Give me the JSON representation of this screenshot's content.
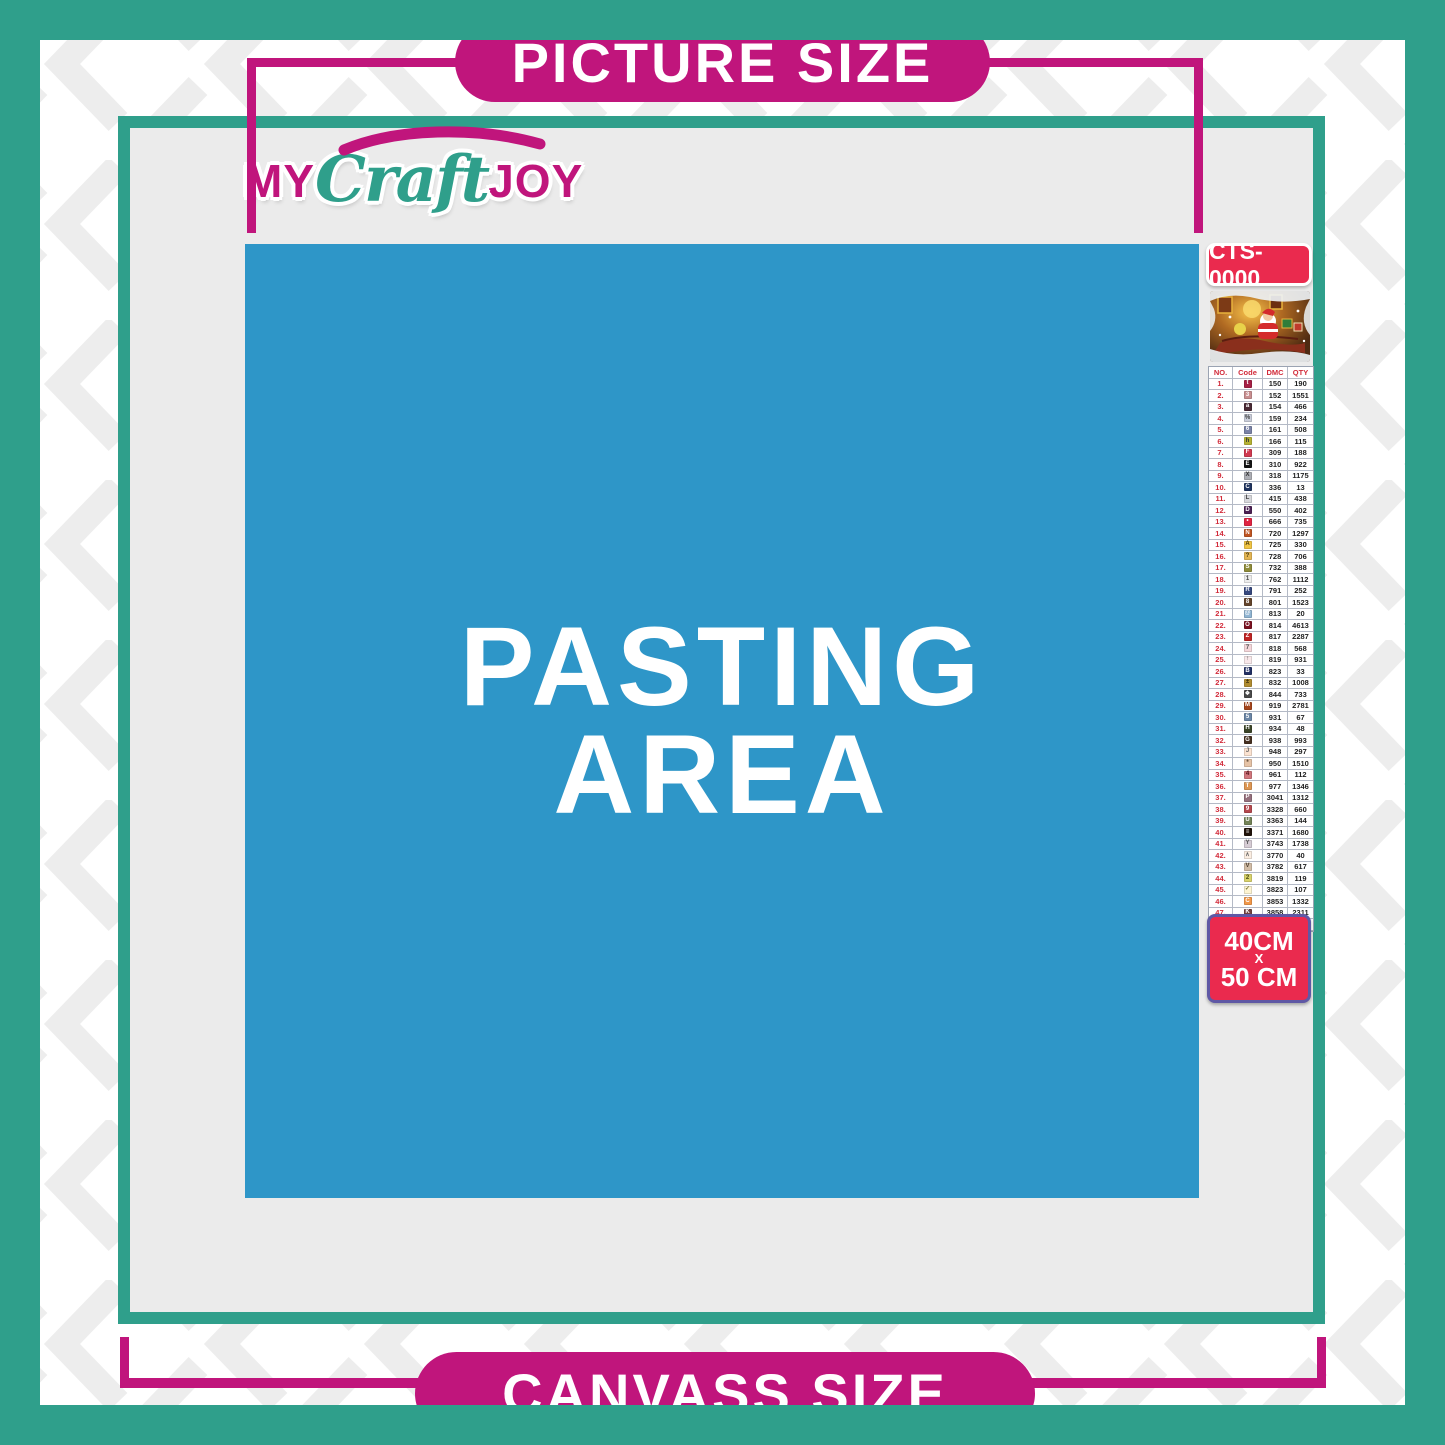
{
  "header": {
    "picture_size_label": "PICTURE SIZE"
  },
  "footer": {
    "canvass_size_label": "CANVASS SIZE"
  },
  "logo": {
    "part1": "MY",
    "part2": "Craft",
    "part3": "JOY"
  },
  "pasting_area": {
    "line1": "PASTING",
    "line2": "AREA"
  },
  "sidebar": {
    "sku": "CTS-0000",
    "size_badge": {
      "line1": "40CM",
      "line2": "X",
      "line3": "50 CM"
    },
    "table": {
      "headers": [
        "NO.",
        "Code",
        "DMC",
        "QTY"
      ],
      "rows": [
        {
          "no": "1.",
          "code": "t",
          "chip_bg": "#a62045",
          "chip_fg": "#ffffff",
          "dmc": "150",
          "qty": "190"
        },
        {
          "no": "2.",
          "code": "3",
          "chip_bg": "#c98f90",
          "chip_fg": "#ffffff",
          "dmc": "152",
          "qty": "1551"
        },
        {
          "no": "3.",
          "code": "a",
          "chip_bg": "#4a2a35",
          "chip_fg": "#ffffff",
          "dmc": "154",
          "qty": "466"
        },
        {
          "no": "4.",
          "code": "%",
          "chip_bg": "#c9cdd9",
          "chip_fg": "#444444",
          "dmc": "159",
          "qty": "234"
        },
        {
          "no": "5.",
          "code": "6",
          "chip_bg": "#7a82a6",
          "chip_fg": "#ffffff",
          "dmc": "161",
          "qty": "508"
        },
        {
          "no": "6.",
          "code": "h",
          "chip_bg": "#b6b233",
          "chip_fg": "#333333",
          "dmc": "166",
          "qty": "115"
        },
        {
          "no": "7.",
          "code": "F",
          "chip_bg": "#d13a51",
          "chip_fg": "#ffffff",
          "dmc": "309",
          "qty": "188"
        },
        {
          "no": "8.",
          "code": "E",
          "chip_bg": "#141414",
          "chip_fg": "#ffffff",
          "dmc": "310",
          "qty": "922"
        },
        {
          "no": "9.",
          "code": "X",
          "chip_bg": "#abadb3",
          "chip_fg": "#333333",
          "dmc": "318",
          "qty": "1175"
        },
        {
          "no": "10.",
          "code": "C",
          "chip_bg": "#20345f",
          "chip_fg": "#ffffff",
          "dmc": "336",
          "qty": "13"
        },
        {
          "no": "11.",
          "code": "L",
          "chip_bg": "#d6d7db",
          "chip_fg": "#444444",
          "dmc": "415",
          "qty": "438"
        },
        {
          "no": "12.",
          "code": "D",
          "chip_bg": "#4b2153",
          "chip_fg": "#ffffff",
          "dmc": "550",
          "qty": "402"
        },
        {
          "no": "13.",
          "code": "•",
          "chip_bg": "#e02542",
          "chip_fg": "#ffffff",
          "dmc": "666",
          "qty": "735"
        },
        {
          "no": "14.",
          "code": "N",
          "chip_bg": "#c05522",
          "chip_fg": "#ffffff",
          "dmc": "720",
          "qty": "1297"
        },
        {
          "no": "15.",
          "code": "A",
          "chip_bg": "#f0c443",
          "chip_fg": "#4a3a10",
          "dmc": "725",
          "qty": "330"
        },
        {
          "no": "16.",
          "code": "?",
          "chip_bg": "#e3b553",
          "chip_fg": "#4a3a10",
          "dmc": "728",
          "qty": "706"
        },
        {
          "no": "17.",
          "code": "S",
          "chip_bg": "#8f8c3a",
          "chip_fg": "#ffffff",
          "dmc": "732",
          "qty": "388"
        },
        {
          "no": "18.",
          "code": "1",
          "chip_bg": "#ededed",
          "chip_fg": "#444444",
          "dmc": "762",
          "qty": "1112"
        },
        {
          "no": "19.",
          "code": "R",
          "chip_bg": "#36487e",
          "chip_fg": "#ffffff",
          "dmc": "791",
          "qty": "252"
        },
        {
          "no": "20.",
          "code": "8",
          "chip_bg": "#64452c",
          "chip_fg": "#ffffff",
          "dmc": "801",
          "qty": "1523"
        },
        {
          "no": "21.",
          "code": "@",
          "chip_bg": "#8fb4d2",
          "chip_fg": "#ffffff",
          "dmc": "813",
          "qty": "20"
        },
        {
          "no": "22.",
          "code": "O",
          "chip_bg": "#7b1120",
          "chip_fg": "#ffffff",
          "dmc": "814",
          "qty": "4613"
        },
        {
          "no": "23.",
          "code": "Z",
          "chip_bg": "#bf2424",
          "chip_fg": "#ffffff",
          "dmc": "817",
          "qty": "2287"
        },
        {
          "no": "24.",
          "code": "7",
          "chip_bg": "#f4d6da",
          "chip_fg": "#555555",
          "dmc": "818",
          "qty": "568"
        },
        {
          "no": "25.",
          "code": "↑",
          "chip_bg": "#f8e8ea",
          "chip_fg": "#555555",
          "dmc": "819",
          "qty": "931"
        },
        {
          "no": "26.",
          "code": "B",
          "chip_bg": "#223165",
          "chip_fg": "#ffffff",
          "dmc": "823",
          "qty": "33"
        },
        {
          "no": "27.",
          "code": "±",
          "chip_bg": "#b08c30",
          "chip_fg": "#3a2d08",
          "dmc": "832",
          "qty": "1008"
        },
        {
          "no": "28.",
          "code": "❖",
          "chip_bg": "#4a4a4a",
          "chip_fg": "#ffffff",
          "dmc": "844",
          "qty": "733"
        },
        {
          "no": "29.",
          "code": "M",
          "chip_bg": "#a4451c",
          "chip_fg": "#ffffff",
          "dmc": "919",
          "qty": "2781"
        },
        {
          "no": "30.",
          "code": "5",
          "chip_bg": "#6b86a6",
          "chip_fg": "#ffffff",
          "dmc": "931",
          "qty": "67"
        },
        {
          "no": "31.",
          "code": "H",
          "chip_bg": "#3b4428",
          "chip_fg": "#ffffff",
          "dmc": "934",
          "qty": "48"
        },
        {
          "no": "32.",
          "code": "G",
          "chip_bg": "#463020",
          "chip_fg": "#ffffff",
          "dmc": "938",
          "qty": "993"
        },
        {
          "no": "33.",
          "code": "J",
          "chip_bg": "#fbe3d1",
          "chip_fg": "#666666",
          "dmc": "948",
          "qty": "297"
        },
        {
          "no": "34.",
          "code": "*",
          "chip_bg": "#e6c3a6",
          "chip_fg": "#5a4632",
          "dmc": "950",
          "qty": "1510"
        },
        {
          "no": "35.",
          "code": "4",
          "chip_bg": "#d0767c",
          "chip_fg": "#51131a",
          "dmc": "961",
          "qty": "112"
        },
        {
          "no": "36.",
          "code": "T",
          "chip_bg": "#dd9652",
          "chip_fg": "#ffffff",
          "dmc": "977",
          "qty": "1346"
        },
        {
          "no": "37.",
          "code": "P",
          "chip_bg": "#95707d",
          "chip_fg": "#ffffff",
          "dmc": "3041",
          "qty": "1312"
        },
        {
          "no": "38.",
          "code": "9",
          "chip_bg": "#b5484e",
          "chip_fg": "#ffffff",
          "dmc": "3328",
          "qty": "660"
        },
        {
          "no": "39.",
          "code": "U",
          "chip_bg": "#738357",
          "chip_fg": "#ffffff",
          "dmc": "3363",
          "qty": "144"
        },
        {
          "no": "40.",
          "code": "≡",
          "chip_bg": "#20130a",
          "chip_fg": "#ffffff",
          "dmc": "3371",
          "qty": "1680"
        },
        {
          "no": "41.",
          "code": "Y",
          "chip_bg": "#d6ccd4",
          "chip_fg": "#555555",
          "dmc": "3743",
          "qty": "1738"
        },
        {
          "no": "42.",
          "code": "∧",
          "chip_bg": "#fbeee2",
          "chip_fg": "#666666",
          "dmc": "3770",
          "qty": "40"
        },
        {
          "no": "43.",
          "code": "V",
          "chip_bg": "#d2bda6",
          "chip_fg": "#4f4030",
          "dmc": "3782",
          "qty": "617"
        },
        {
          "no": "44.",
          "code": "2",
          "chip_bg": "#d9d36c",
          "chip_fg": "#4a4a12",
          "dmc": "3819",
          "qty": "119"
        },
        {
          "no": "45.",
          "code": "✓",
          "chip_bg": "#fdf4d2",
          "chip_fg": "#777733",
          "dmc": "3823",
          "qty": "107"
        },
        {
          "no": "46.",
          "code": "C",
          "chip_bg": "#f29849",
          "chip_fg": "#ffffff",
          "dmc": "3853",
          "qty": "1332"
        },
        {
          "no": "47.",
          "code": "K",
          "chip_bg": "#754341",
          "chip_fg": "#ffffff",
          "dmc": "3858",
          "qty": "2311"
        },
        {
          "no": "48.",
          "code": "A",
          "chip_bg": "#a5856d",
          "chip_fg": "#ffffff",
          "dmc": "3863",
          "qty": "1820"
        }
      ]
    }
  },
  "colors": {
    "teal": "#2f9f8b",
    "magenta": "#c0157c",
    "red_badge": "#ea2a4e",
    "blue_pasting": "#2e96c8",
    "interior_gray": "#ebebeb"
  }
}
